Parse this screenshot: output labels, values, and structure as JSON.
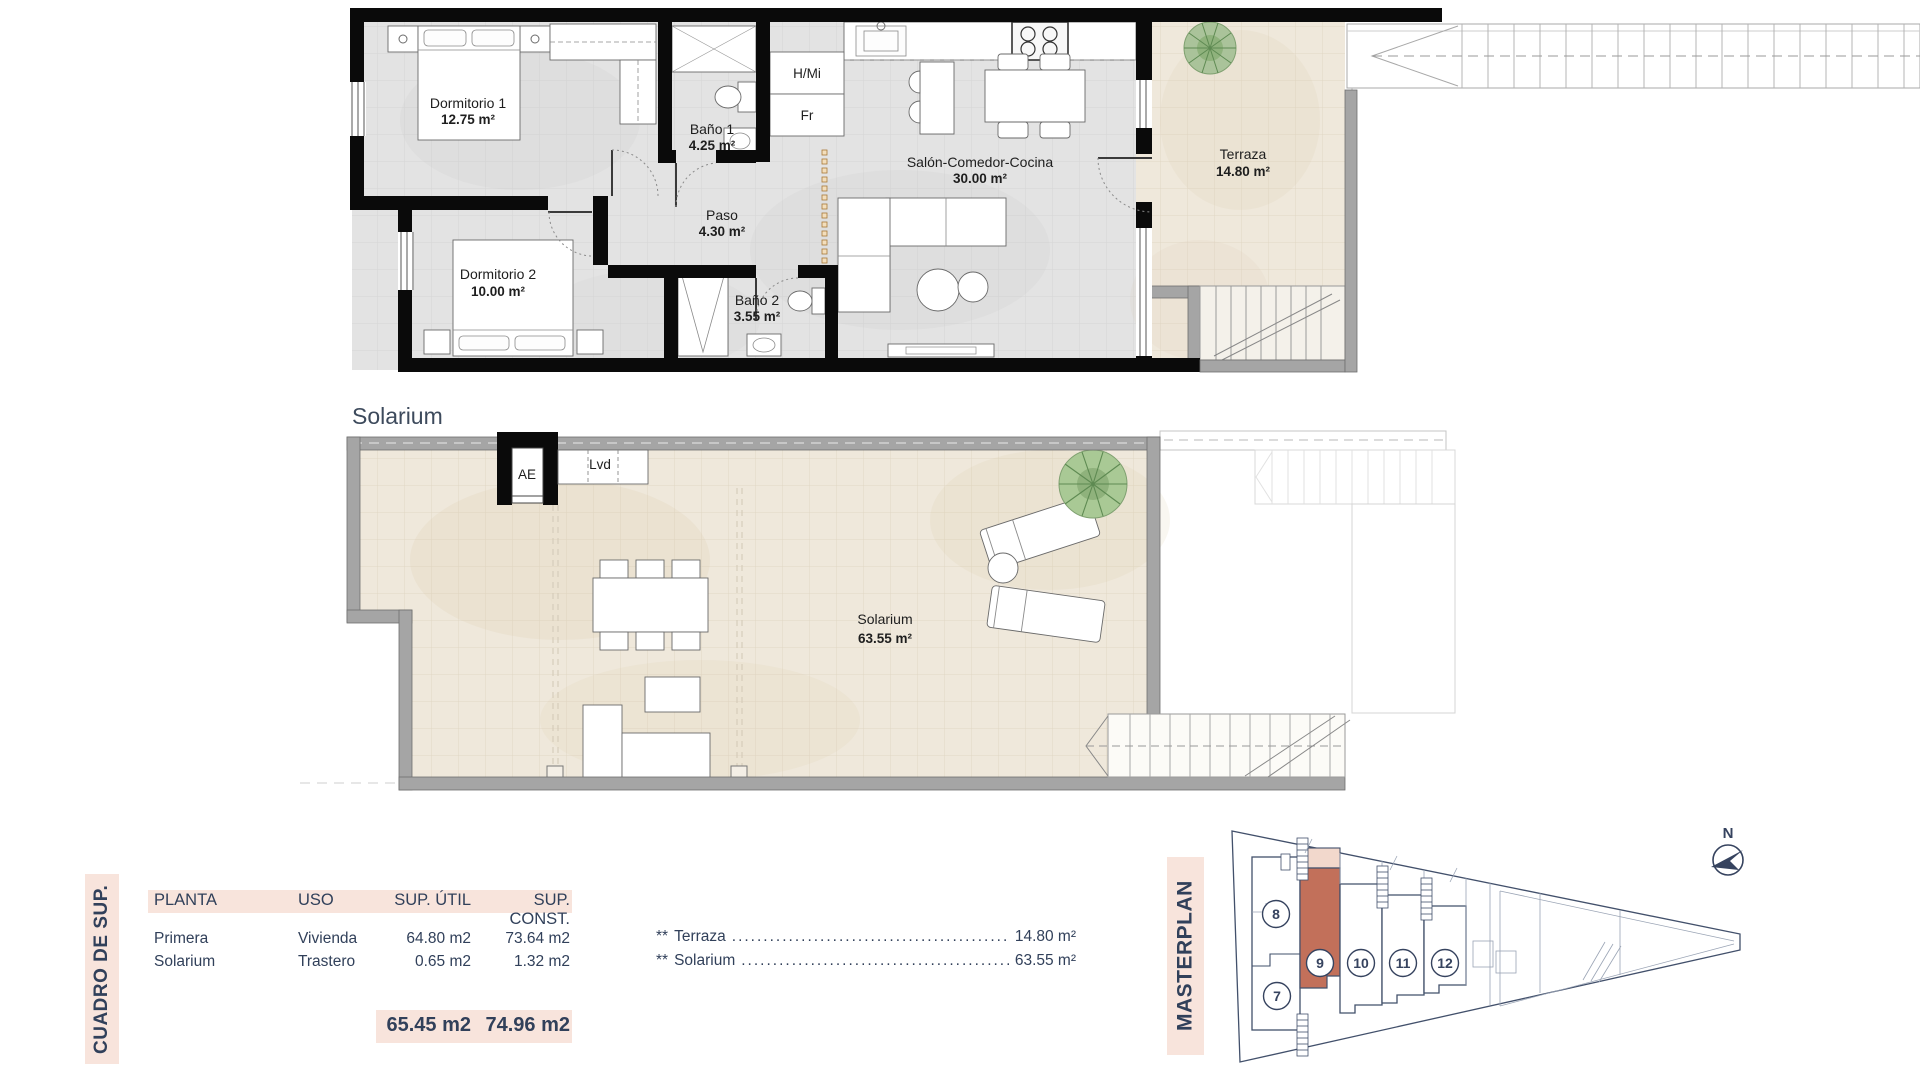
{
  "colors": {
    "accent_pink": "#f8e4dc",
    "navy_text": "#31405a",
    "unit_highlight": "#c2705a",
    "unit_highlight_light": "#f2d8cc",
    "plan_wall": "#0a0a0a",
    "floor_gray": "#e3e3e3",
    "floor_beige": "#efe8db"
  },
  "plan_upper": {
    "rooms": {
      "dormitorio1": {
        "name": "Dormitorio 1",
        "area": "12.75 m²"
      },
      "bano1": {
        "name": "Baño 1",
        "area": "4.25 m²"
      },
      "dormitorio2": {
        "name": "Dormitorio 2",
        "area": "10.00 m²"
      },
      "bano2": {
        "name": "Baño 2",
        "area": "3.55 m²"
      },
      "paso": {
        "name": "Paso",
        "area": "4.30 m²"
      },
      "salon": {
        "name": "Salón-Comedor-Cocina",
        "area": "30.00 m²"
      },
      "terraza": {
        "name": "Terraza",
        "area": "14.80 m²"
      }
    },
    "labels": {
      "hmi": "H/Mi",
      "fr": "Fr"
    }
  },
  "plan_solarium": {
    "heading": "Solarium",
    "room": {
      "name": "Solarium",
      "area": "63.55 m²"
    },
    "labels": {
      "ae": "AE",
      "lvd": "Lvd"
    }
  },
  "summary_table": {
    "side_title": "CUADRO DE SUP.",
    "headers": [
      "PLANTA",
      "USO",
      "SUP. ÚTIL",
      "SUP. CONST."
    ],
    "rows": [
      [
        "Primera",
        "Vivienda",
        "64.80 m2",
        "73.64 m2"
      ],
      [
        "Solarium",
        "Trastero",
        "0.65 m2",
        "1.32 m2"
      ]
    ],
    "totals": {
      "util": "65.45 m2",
      "construida": "74.96 m2"
    },
    "annotations": [
      {
        "prefix": "**",
        "label": "Terraza",
        "dots": "..........................................................................",
        "value": "14.80 m²"
      },
      {
        "prefix": "**",
        "label": "Solarium",
        "dots": "..........................................................................",
        "value": "63.55 m²"
      }
    ]
  },
  "masterplan": {
    "side_title": "MASTERPLAN",
    "compass_label": "N",
    "highlighted_unit": "9",
    "units": [
      {
        "label": "8"
      },
      {
        "label": "7"
      },
      {
        "label": "9"
      },
      {
        "label": "10"
      },
      {
        "label": "11"
      },
      {
        "label": "12"
      }
    ]
  }
}
